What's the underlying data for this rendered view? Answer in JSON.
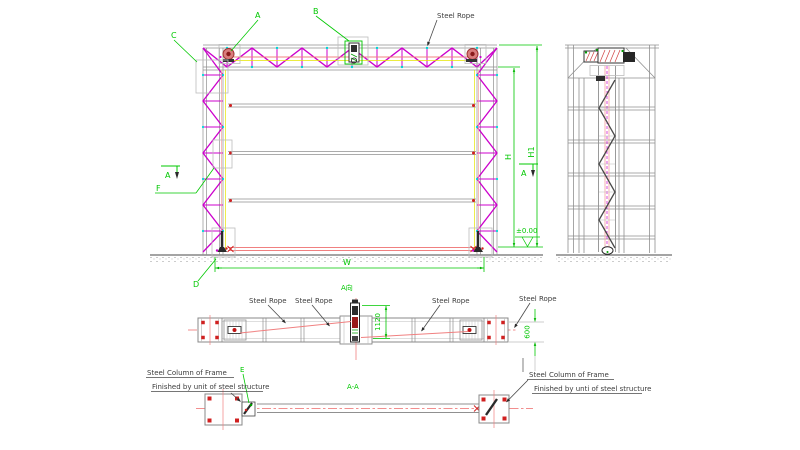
{
  "colors": {
    "truss_magenta": "#cc00cc",
    "frame_gray": "#909090",
    "dimension_green": "#00c800",
    "rope_red": "#f08080",
    "bolt_red": "#d02020",
    "node_cyan": "#00d4d4",
    "guide_yellow": "#e6e600",
    "annotation_dark": "#3c3c3c"
  },
  "front_view": {
    "detail_labels": {
      "a": "A",
      "b": "B",
      "c": "C",
      "d": "D",
      "f": "F"
    },
    "section_arrow_label": "A",
    "rope_label": "Steel Rope",
    "dim_width": "W",
    "dim_height": "H",
    "dim_height_total": "H1",
    "level_mark": "±0.00"
  },
  "plan_view": {
    "view_label": "A向",
    "rope_labels": [
      "Steel Rope",
      "Steel Rope",
      "Steel Rope",
      "Steel Rope"
    ],
    "dim_center_offset": "1120",
    "dim_beam_depth": "600"
  },
  "section_view": {
    "view_label": "A-A",
    "detail_label_e": "E",
    "left_column_note": [
      "Steel Column of  Frame",
      "Finished by unit of steel structure"
    ],
    "right_column_note": [
      "Steel Column of  Frame",
      "Finished by unti of steel structure"
    ]
  }
}
